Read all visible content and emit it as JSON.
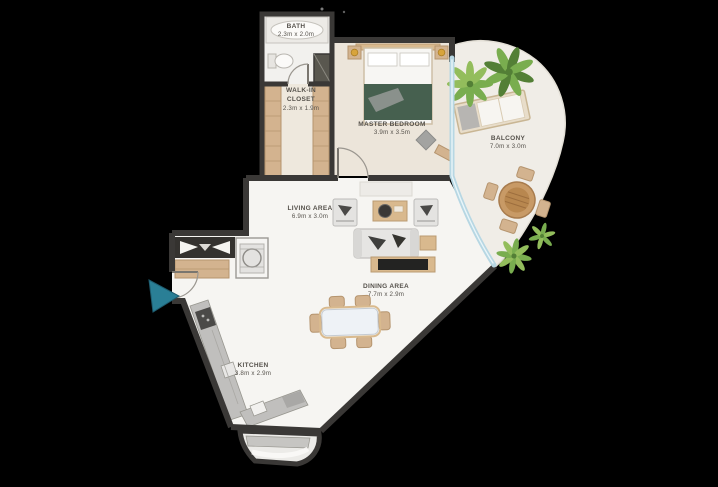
{
  "colors": {
    "background": "#000000",
    "walls": "#3a3836",
    "floor_main": "#f6f5f2",
    "floor_bedroom": "#ece5da",
    "floor_closet": "#eee8dd",
    "floor_balcony": "#f0ede7",
    "wood": "#d9b98e",
    "glass": "#b7d7e3",
    "plant_green": "#79ad4f",
    "bed_blanket": "#46604f",
    "entry_arrow": "#2a7f96",
    "label_text": "#55514b"
  },
  "icons": {
    "entry_arrow": "teal-triangle-pointing-right"
  },
  "rooms": [
    {
      "id": "bath",
      "name": "BATH",
      "dims": "2.3m x 2.0m"
    },
    {
      "id": "walk_in_closet",
      "name": "WALK-IN CLOSET",
      "dims": "2.3m x 1.9m"
    },
    {
      "id": "master_bedroom",
      "name": "MASTER BEDROOM",
      "dims": "3.9m x 3.5m"
    },
    {
      "id": "balcony",
      "name": "BALCONY",
      "dims": "7.0m x 3.0m"
    },
    {
      "id": "living_area",
      "name": "LIVING AREA",
      "dims": "6.9m x 3.0m"
    },
    {
      "id": "dining_area",
      "name": "DINING AREA",
      "dims": "7.7m x 2.9m"
    },
    {
      "id": "kitchen",
      "name": "KITCHEN",
      "dims": "3.8m x 2.9m"
    }
  ]
}
